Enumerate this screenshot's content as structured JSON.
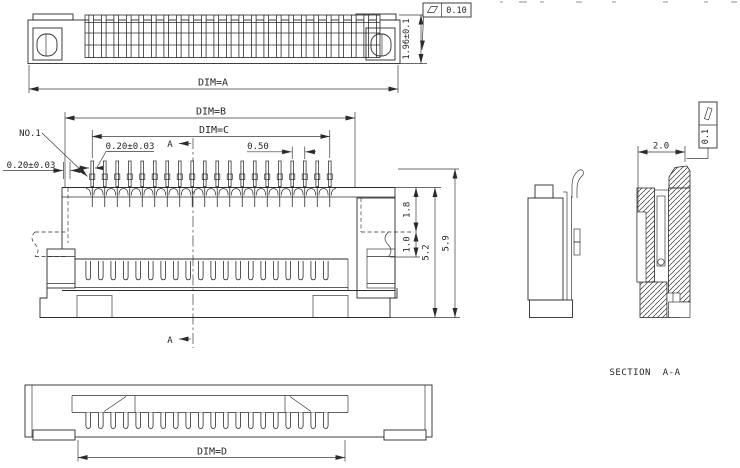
{
  "top_view": {
    "dim_label": "DIM=A",
    "height_tolerance": "1.96±0.1",
    "flatness_tolerance": "0.10"
  },
  "front_view": {
    "dim_b": "DIM=B",
    "dim_c": "DIM=C",
    "first_pin_label": "NO.1",
    "pin_width_tolerance": "0.20±0.03",
    "edge_margin_tolerance": "0.20±0.03",
    "pitch": "0.50",
    "depth_upper": "1.8",
    "depth_lower": "1.0",
    "body_height": "5.2",
    "overall_height": "5.9",
    "section_arrow_top": "A",
    "section_arrow_bottom": "A"
  },
  "section_view": {
    "width": "2.0",
    "flatness_tolerance": "0.1",
    "caption": "SECTION  A-A"
  },
  "bottom_view": {
    "dim_label": "DIM=D"
  }
}
